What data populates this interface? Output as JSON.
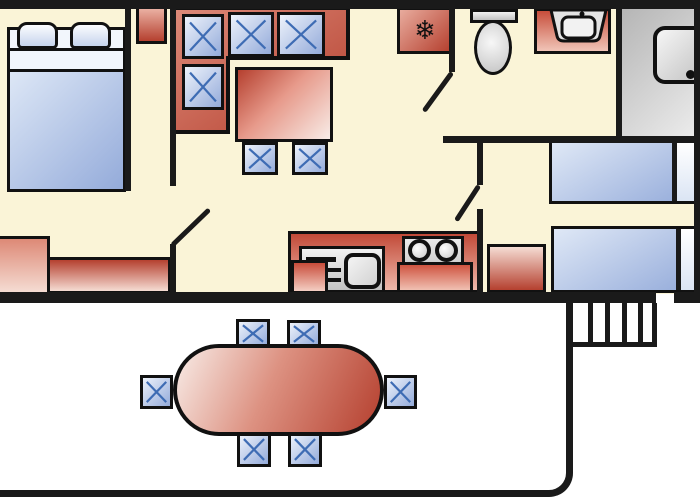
{
  "plan": {
    "type": "floor-plan",
    "subject": "mobile-home with terrace",
    "rooms": [
      {
        "id": "master-bedroom",
        "furniture": [
          "double-bed-with-two-pillows",
          "top-wardrobe",
          "tall-cabinet",
          "low-cabinet"
        ]
      },
      {
        "id": "living-room",
        "furniture": [
          "corner-sofa-with-4-cushions",
          "dining-table",
          "chair",
          "chair"
        ]
      },
      {
        "id": "kitchen",
        "furniture": [
          "fridge",
          "counter",
          "sink-unit-with-drainer",
          "hob-with-2-burners",
          "base-cabinet",
          "base-cabinet"
        ]
      },
      {
        "id": "wc",
        "furniture": [
          "toilet",
          "washbasin-counter"
        ]
      },
      {
        "id": "shower-room",
        "furniture": [
          "shower-tray"
        ]
      },
      {
        "id": "twin-bedroom",
        "furniture": [
          "single-bed",
          "single-bed",
          "cabinet"
        ]
      },
      {
        "id": "terrace",
        "furniture": [
          "oval-garden-table",
          "chair",
          "chair",
          "chair",
          "chair",
          "chair",
          "chair",
          "entrance-steps"
        ]
      }
    ],
    "counts": {
      "sofa_cushions": 4,
      "terrace_chairs": 6,
      "hob_burners": 2,
      "steps": 5
    }
  },
  "icons": {
    "snowflake": "❄"
  },
  "palette": {
    "wall": "#1a1a1a",
    "outline": "#111111",
    "floor": "#faf4d7",
    "deck": "#ffffff",
    "red-dark": "#b5402f",
    "red-light": "#f5dcd3",
    "red-pale": "#f8ece7",
    "blue-dark": "#94abda",
    "blue-light": "#edf2fb",
    "blue-stroke": "#3e6cb4",
    "gray-dark": "#c2c2c2",
    "gray-light": "#f2f2f2"
  }
}
